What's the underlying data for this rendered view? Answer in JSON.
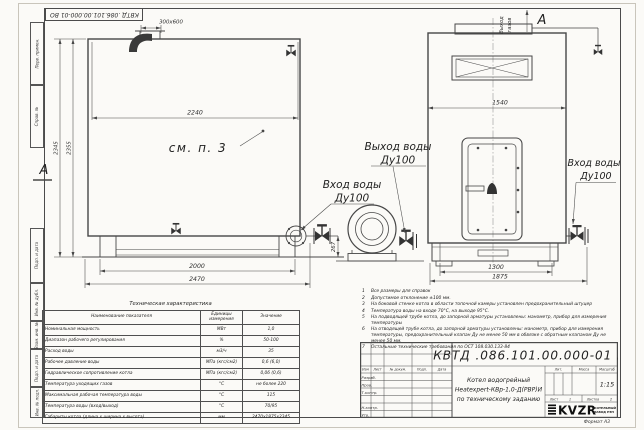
{
  "frame": {
    "stamp_top": "КВТД .086.101.00.000-01 ВО",
    "margin_labels": [
      "Перв. примен.",
      "Справ. №",
      "Подп. и дата",
      "Инв. № дубл.",
      "Взам. инв. №",
      "Подп. и дата",
      "Инв. № подл."
    ],
    "format_label": "Формат А3"
  },
  "drawing": {
    "side_view": {
      "marker": "А",
      "see_note": "см. п. 3",
      "dim_top_width": "2240",
      "dim_chimney": "300x600",
      "dim_height_outer": "2345",
      "dim_height_inner": "2355",
      "dim_base": "2000",
      "dim_base_full": "2470",
      "dim_pipe_height": "267"
    },
    "front_view": {
      "marker": "А",
      "gas_outlet_line1": "Выход",
      "gas_outlet_line2": "газов",
      "dim_width": "1540",
      "dim_base": "1300",
      "dim_base_full": "1875"
    },
    "labels": {
      "water_outlet": "Выход воды",
      "water_outlet_dn": "Ду100",
      "water_inlet_mid": "Вход воды",
      "water_inlet_mid_dn": "Ду100",
      "water_inlet_right": "Вход воды",
      "water_inlet_right_dn": "Ду100"
    }
  },
  "spec_table": {
    "title": "Техническая характеристика",
    "headers": [
      "Наименование показателя",
      "Единицы измерения",
      "Значение"
    ],
    "rows": [
      [
        "Номинальная мощность",
        "МВт",
        "1,0"
      ],
      [
        "Диапазон рабочего регулирования",
        "%",
        "50-100"
      ],
      [
        "Расход воды",
        "м3/ч",
        "35"
      ],
      [
        "Рабочее давление воды",
        "МПа (кгс/см2)",
        "0,6 (6,0)"
      ],
      [
        "Гидравлическое сопротивление котла",
        "МПа (кгс/см2)",
        "0,06 (0,6)"
      ],
      [
        "Температура уходящих газов",
        "°С",
        "не более 220"
      ],
      [
        "Максимальная рабочая температура воды",
        "°С",
        "115"
      ],
      [
        "Температура воды (вход/выход)",
        "°С",
        "70/95"
      ],
      [
        "Габариты котла (длина х ширина х высота)",
        "мм",
        "2470х1875х2345"
      ]
    ]
  },
  "notes": {
    "items": [
      {
        "num": "1",
        "text": "Все размеры для справок"
      },
      {
        "num": "2",
        "text": "Допустимое отклонение ±100 мм."
      },
      {
        "num": "3",
        "text": "На боковой стенке котла в области топочной камеры установлен предохранительный штуцер"
      },
      {
        "num": "4",
        "text": "Температура воды на входе 70°С, на выходе 95°С."
      },
      {
        "num": "5",
        "text": "На подводящей трубе котла, до запорной арматуры установлены: манометр, прибор для измерения температуры"
      },
      {
        "num": "6",
        "text": "На отводящей трубе котла, до запорной арматуры установлены: манометр, прибор для измерения температуры, предохранительный клапан Ду не менее 50 мм в обвязке с обратным клапаном Ду не менее 50 мм."
      },
      {
        "num": "7",
        "text": "Остальные технические требования по ОСТ 108.030.133-84"
      }
    ]
  },
  "title_block": {
    "doc_number": "КВТД .086.101.00.000-01  ВО",
    "title_line1": "Котел водогрейный",
    "title_line2": "Heatexpert-КВр-1,0-Д(РВР)И",
    "title_line3": "по техническому заданию",
    "col_headers": [
      "Изм",
      "Лист",
      "№ докум.",
      "Подп.",
      "Дата"
    ],
    "row_labels": [
      "Разраб.",
      "Пров.",
      "Т.контр.",
      "Н.контр.",
      "Утв."
    ],
    "lit_label": "Лит.",
    "mass_label": "Масса",
    "scale_label": "Масштаб",
    "scale_value": "1:15",
    "sheet_label": "Лист",
    "sheet_value": "1",
    "sheets_label": "Листов",
    "sheets_value": "2",
    "logo_text": "KVZR",
    "logo_sub1": "КОТЕЛЬНЫЙ",
    "logo_sub2": "ЗАВОД РЭП"
  }
}
